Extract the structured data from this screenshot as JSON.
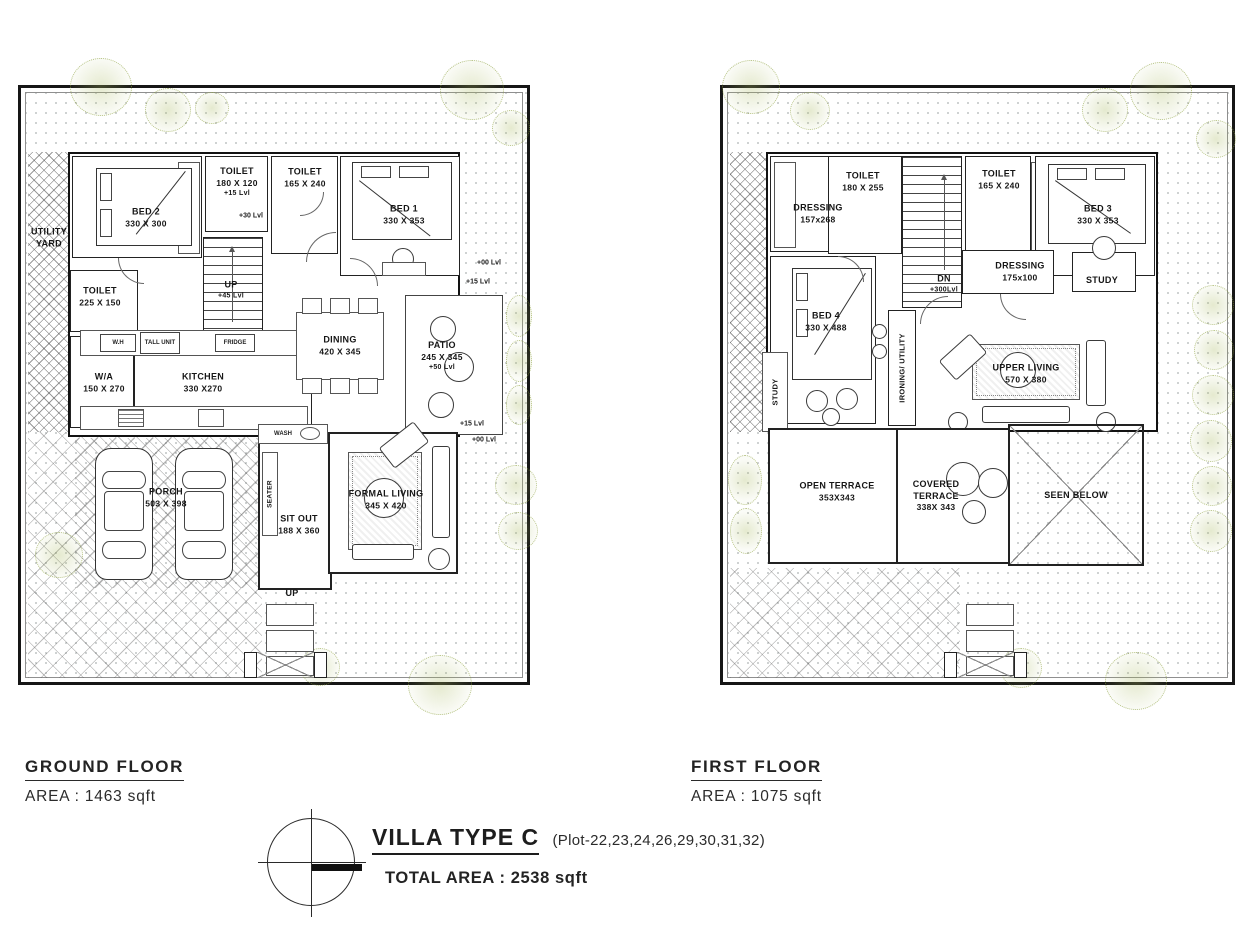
{
  "ground_floor": {
    "title": "GROUND FLOOR",
    "area_label": "AREA : 1463 sqft",
    "rooms": {
      "utility_yard": {
        "label": "UTILITY YARD"
      },
      "bed2": {
        "label": "BED 2",
        "dims": "330 X 300"
      },
      "toilet_a": {
        "label": "TOILET",
        "dims": "180 X 120",
        "level": "+15 Lvl"
      },
      "toilet_b": {
        "label": "TOILET",
        "dims": "165 X 240"
      },
      "bed1": {
        "label": "BED 1",
        "dims": "330 X 353"
      },
      "toilet_c": {
        "label": "TOILET",
        "dims": "225 X 150"
      },
      "wa": {
        "label": "W/A",
        "dims": "150 X 270"
      },
      "kitchen": {
        "label": "KITCHEN",
        "dims": "330 X270"
      },
      "dining": {
        "label": "DINING",
        "dims": "420 X 345"
      },
      "patio": {
        "label": "PATIO",
        "dims": "245 X 345",
        "level": "+50 Lvl"
      },
      "porch": {
        "label": "PORCH",
        "dims": "503 X 398"
      },
      "sit_out": {
        "label": "SIT OUT",
        "dims": "188 X 360"
      },
      "formal_living": {
        "label": "FORMAL LIVING",
        "dims": "345 X 420"
      }
    },
    "fixtures": {
      "wh": "W.H",
      "tall_unit": "TALL UNIT",
      "fridge": "FRIDGE",
      "wash": "WASH",
      "seater": "SEATER"
    },
    "stairs": {
      "up": "UP",
      "up_level": "+45 Lvl",
      "mid_level": "+30 Lvl",
      "entry_up": "UP"
    },
    "levels": {
      "l00": "+00 Lvl",
      "l15": "+15 Lvl"
    }
  },
  "first_floor": {
    "title": "FIRST FLOOR",
    "area_label": "AREA : 1075 sqft",
    "rooms": {
      "dressing_a": {
        "label": "DRESSING",
        "dims": "157x268"
      },
      "toilet_d": {
        "label": "TOILET",
        "dims": "180 X 255"
      },
      "toilet_e": {
        "label": "TOILET",
        "dims": "165 X 240"
      },
      "bed3": {
        "label": "BED 3",
        "dims": "330 X 353"
      },
      "dressing_b": {
        "label": "DRESSING",
        "dims": "175x100"
      },
      "study_a": {
        "label": "STUDY"
      },
      "bed4": {
        "label": "BED 4",
        "dims": "330 X 488"
      },
      "ironing": {
        "label": "IRONING/ UTILITY"
      },
      "study_b": {
        "label": "STUDY"
      },
      "upper_living": {
        "label": "UPPER LIVING",
        "dims": "570 X 380"
      },
      "open_terrace": {
        "label": "OPEN TERRACE",
        "dims": "353X343"
      },
      "covered_terrace_1": {
        "label": "COVERED"
      },
      "covered_terrace_2": {
        "label": "TERRACE"
      },
      "covered_terrace_dims": {
        "dims": "338X 343"
      },
      "seen_below": {
        "label": "SEEN BELOW"
      }
    },
    "stairs": {
      "dn": "DN",
      "dn_level": "+300Lvl"
    }
  },
  "footer": {
    "title": "VILLA TYPE C",
    "plots": "(Plot-22,23,24,26,29,30,31,32)",
    "total_area": "TOTAL AREA : 2538 sqft"
  }
}
